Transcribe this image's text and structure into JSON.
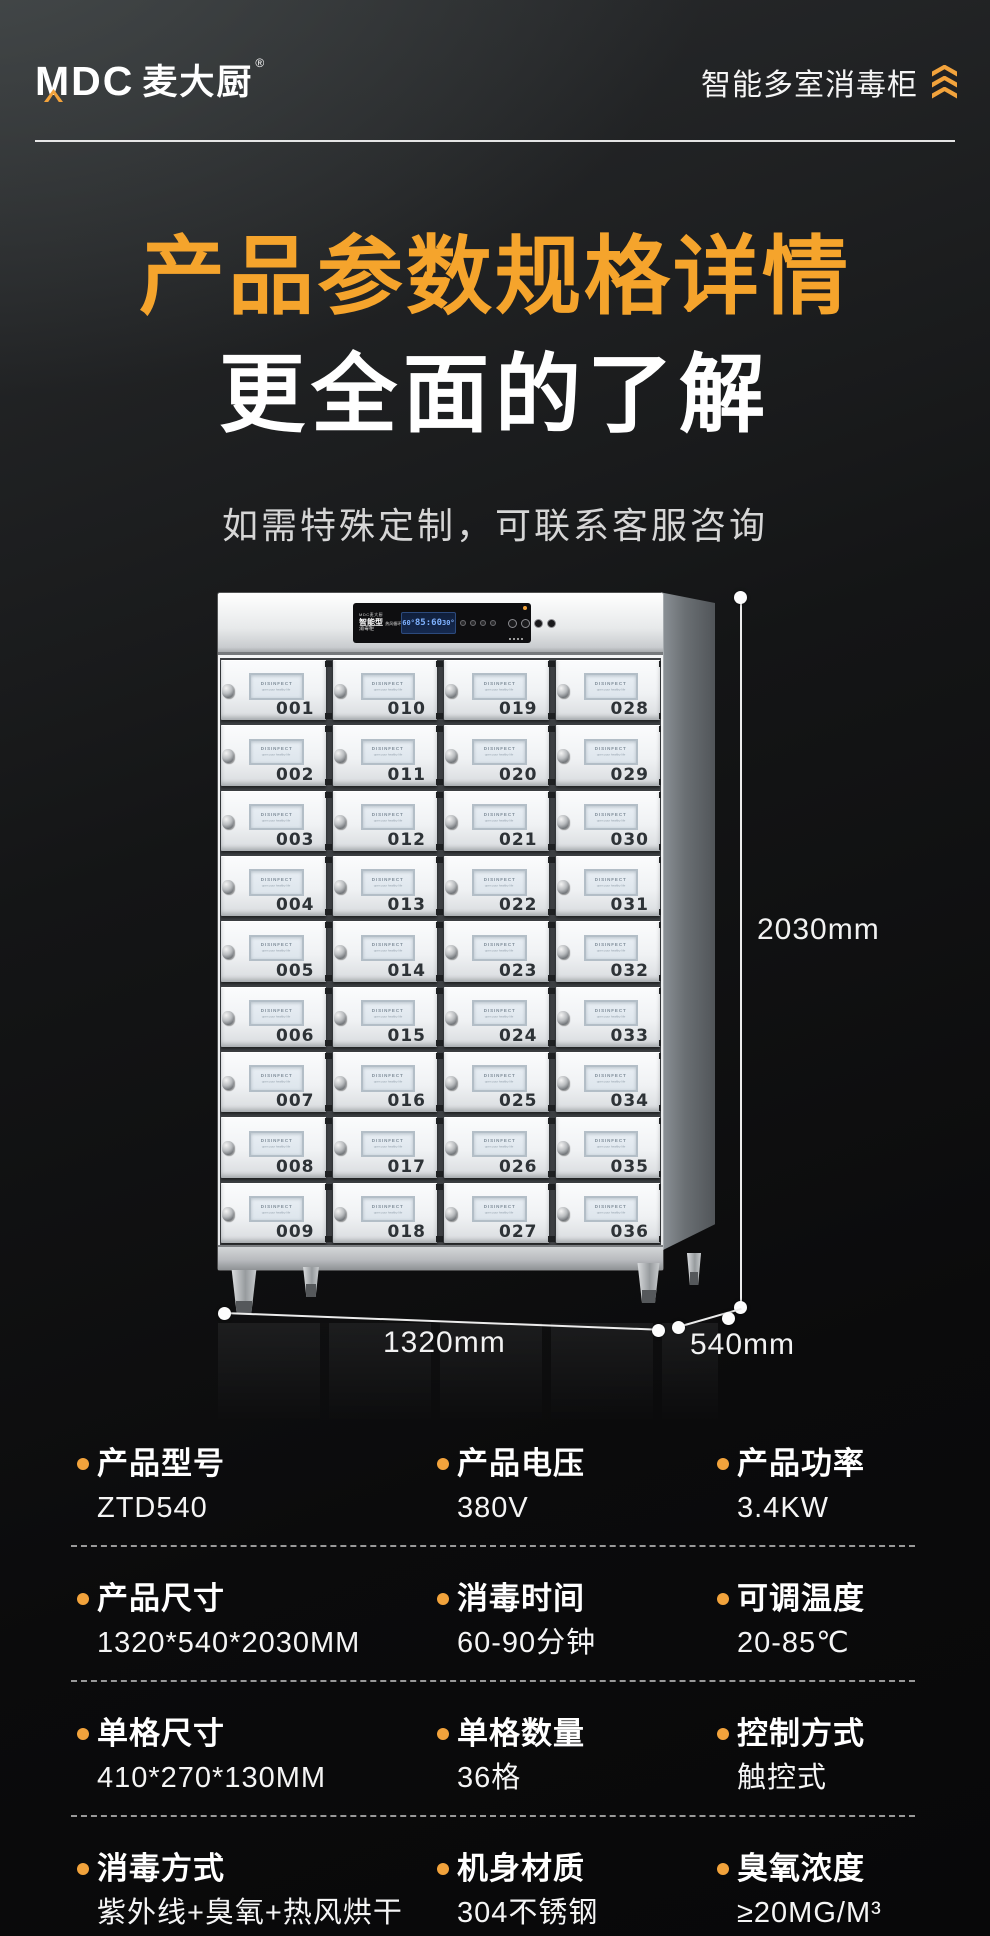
{
  "colors": {
    "accent": "#F2A33C",
    "title_orange": "#F5A42C"
  },
  "header": {
    "logo_mdc": "MDC",
    "logo_cn": "麦大厨",
    "reg": "®",
    "product_tag": "智能多室消毒柜"
  },
  "hero": {
    "title_line1": "产品参数规格详情",
    "title_line2": "更全面的了解",
    "subtitle": "如需特殊定制，可联系客服咨询"
  },
  "cabinet": {
    "panel": {
      "brand": "MDC麦大厨",
      "model": "智能型",
      "model_sub": "热风循环",
      "type": "消毒柜",
      "lcd": [
        "60°",
        "85:60",
        "30°"
      ]
    },
    "door_window": {
      "line1": "DISINFECT",
      "line2": "open your healthy life"
    },
    "door_columns": [
      [
        "001",
        "002",
        "003",
        "004",
        "005",
        "006",
        "007",
        "008",
        "009"
      ],
      [
        "010",
        "011",
        "012",
        "013",
        "014",
        "015",
        "016",
        "017",
        "018"
      ],
      [
        "019",
        "020",
        "021",
        "022",
        "023",
        "024",
        "025",
        "026",
        "027"
      ],
      [
        "028",
        "029",
        "030",
        "031",
        "032",
        "033",
        "034",
        "035",
        "036"
      ]
    ]
  },
  "dimensions": {
    "height": "2030mm",
    "width": "1320mm",
    "depth": "540mm"
  },
  "specs": {
    "rows": [
      [
        {
          "label": "产品型号",
          "value": "ZTD540"
        },
        {
          "label": "产品电压",
          "value": "380V"
        },
        {
          "label": "产品功率",
          "value": "3.4KW"
        }
      ],
      [
        {
          "label": "产品尺寸",
          "value": "1320*540*2030MM"
        },
        {
          "label": "消毒时间",
          "value": "60-90分钟"
        },
        {
          "label": "可调温度",
          "value": "20-85℃"
        }
      ],
      [
        {
          "label": "单格尺寸",
          "value": "410*270*130MM"
        },
        {
          "label": "单格数量",
          "value": "36格"
        },
        {
          "label": "控制方式",
          "value": "触控式"
        }
      ],
      [
        {
          "label": "消毒方式",
          "value": "紫外线+臭氧+热风烘干"
        },
        {
          "label": "机身材质",
          "value": "304不锈钢"
        },
        {
          "label": "臭氧浓度",
          "value": "≥20MG/M³"
        }
      ]
    ]
  }
}
